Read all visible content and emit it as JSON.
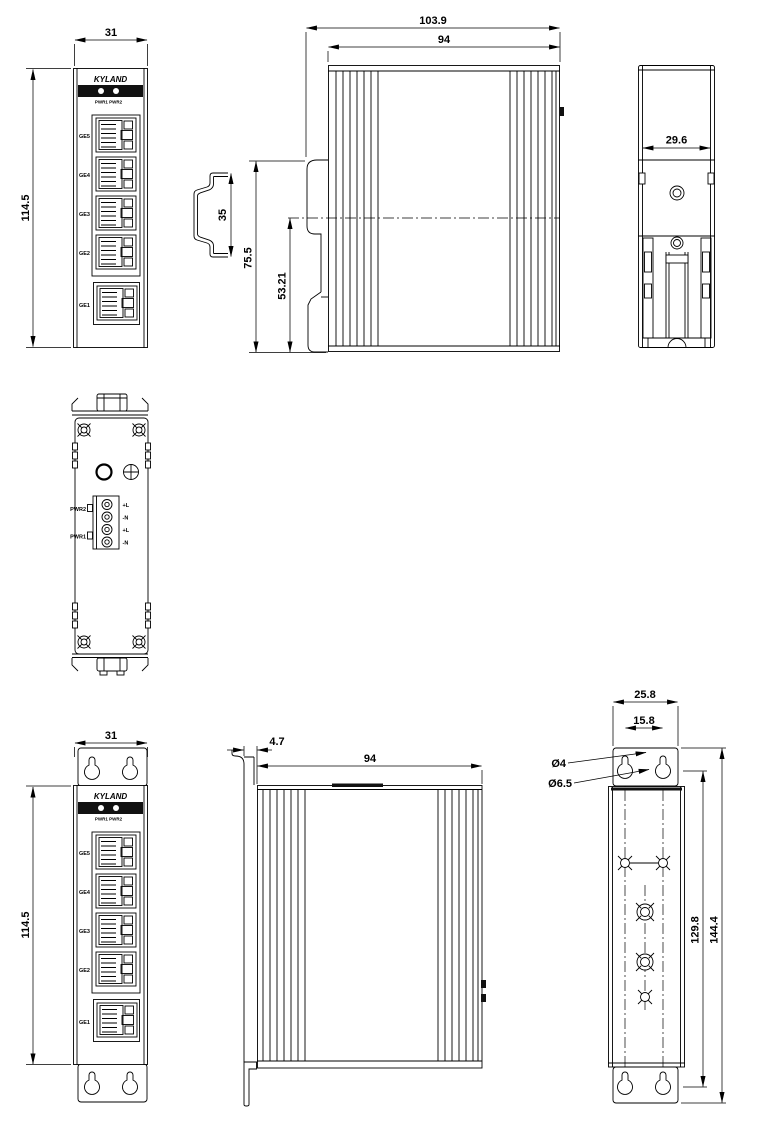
{
  "device": {
    "brand": "KYLAND",
    "led_label": "PWR1 PWR2",
    "ports": [
      "GE5",
      "GE4",
      "GE3",
      "GE2",
      "GE1"
    ]
  },
  "views": {
    "front_din": {
      "width": "31",
      "height": "114.5"
    },
    "din_rail_profile": {
      "height": "35"
    },
    "side_din": {
      "depth_total": "103.9",
      "depth_body": "94",
      "clip_height": "75.5",
      "rail_offset": "53.21"
    },
    "rear_din": {
      "width": "29.6"
    },
    "top_power": {
      "pwr_upper": "PWR2",
      "pwr_lower": "PWR1",
      "pins": [
        "+L",
        "-N",
        "+L",
        "-N"
      ]
    },
    "front_wall": {
      "width": "31",
      "height": "114.5"
    },
    "side_wall": {
      "plate_offset": "4.7",
      "depth_body": "94"
    },
    "rear_wall": {
      "plate_width": "25.8",
      "hole_spacing": "15.8",
      "slot_dia": "Ø4",
      "hole_dia": "Ø6.5",
      "hole_span": "129.8",
      "total_height": "144.4"
    }
  }
}
